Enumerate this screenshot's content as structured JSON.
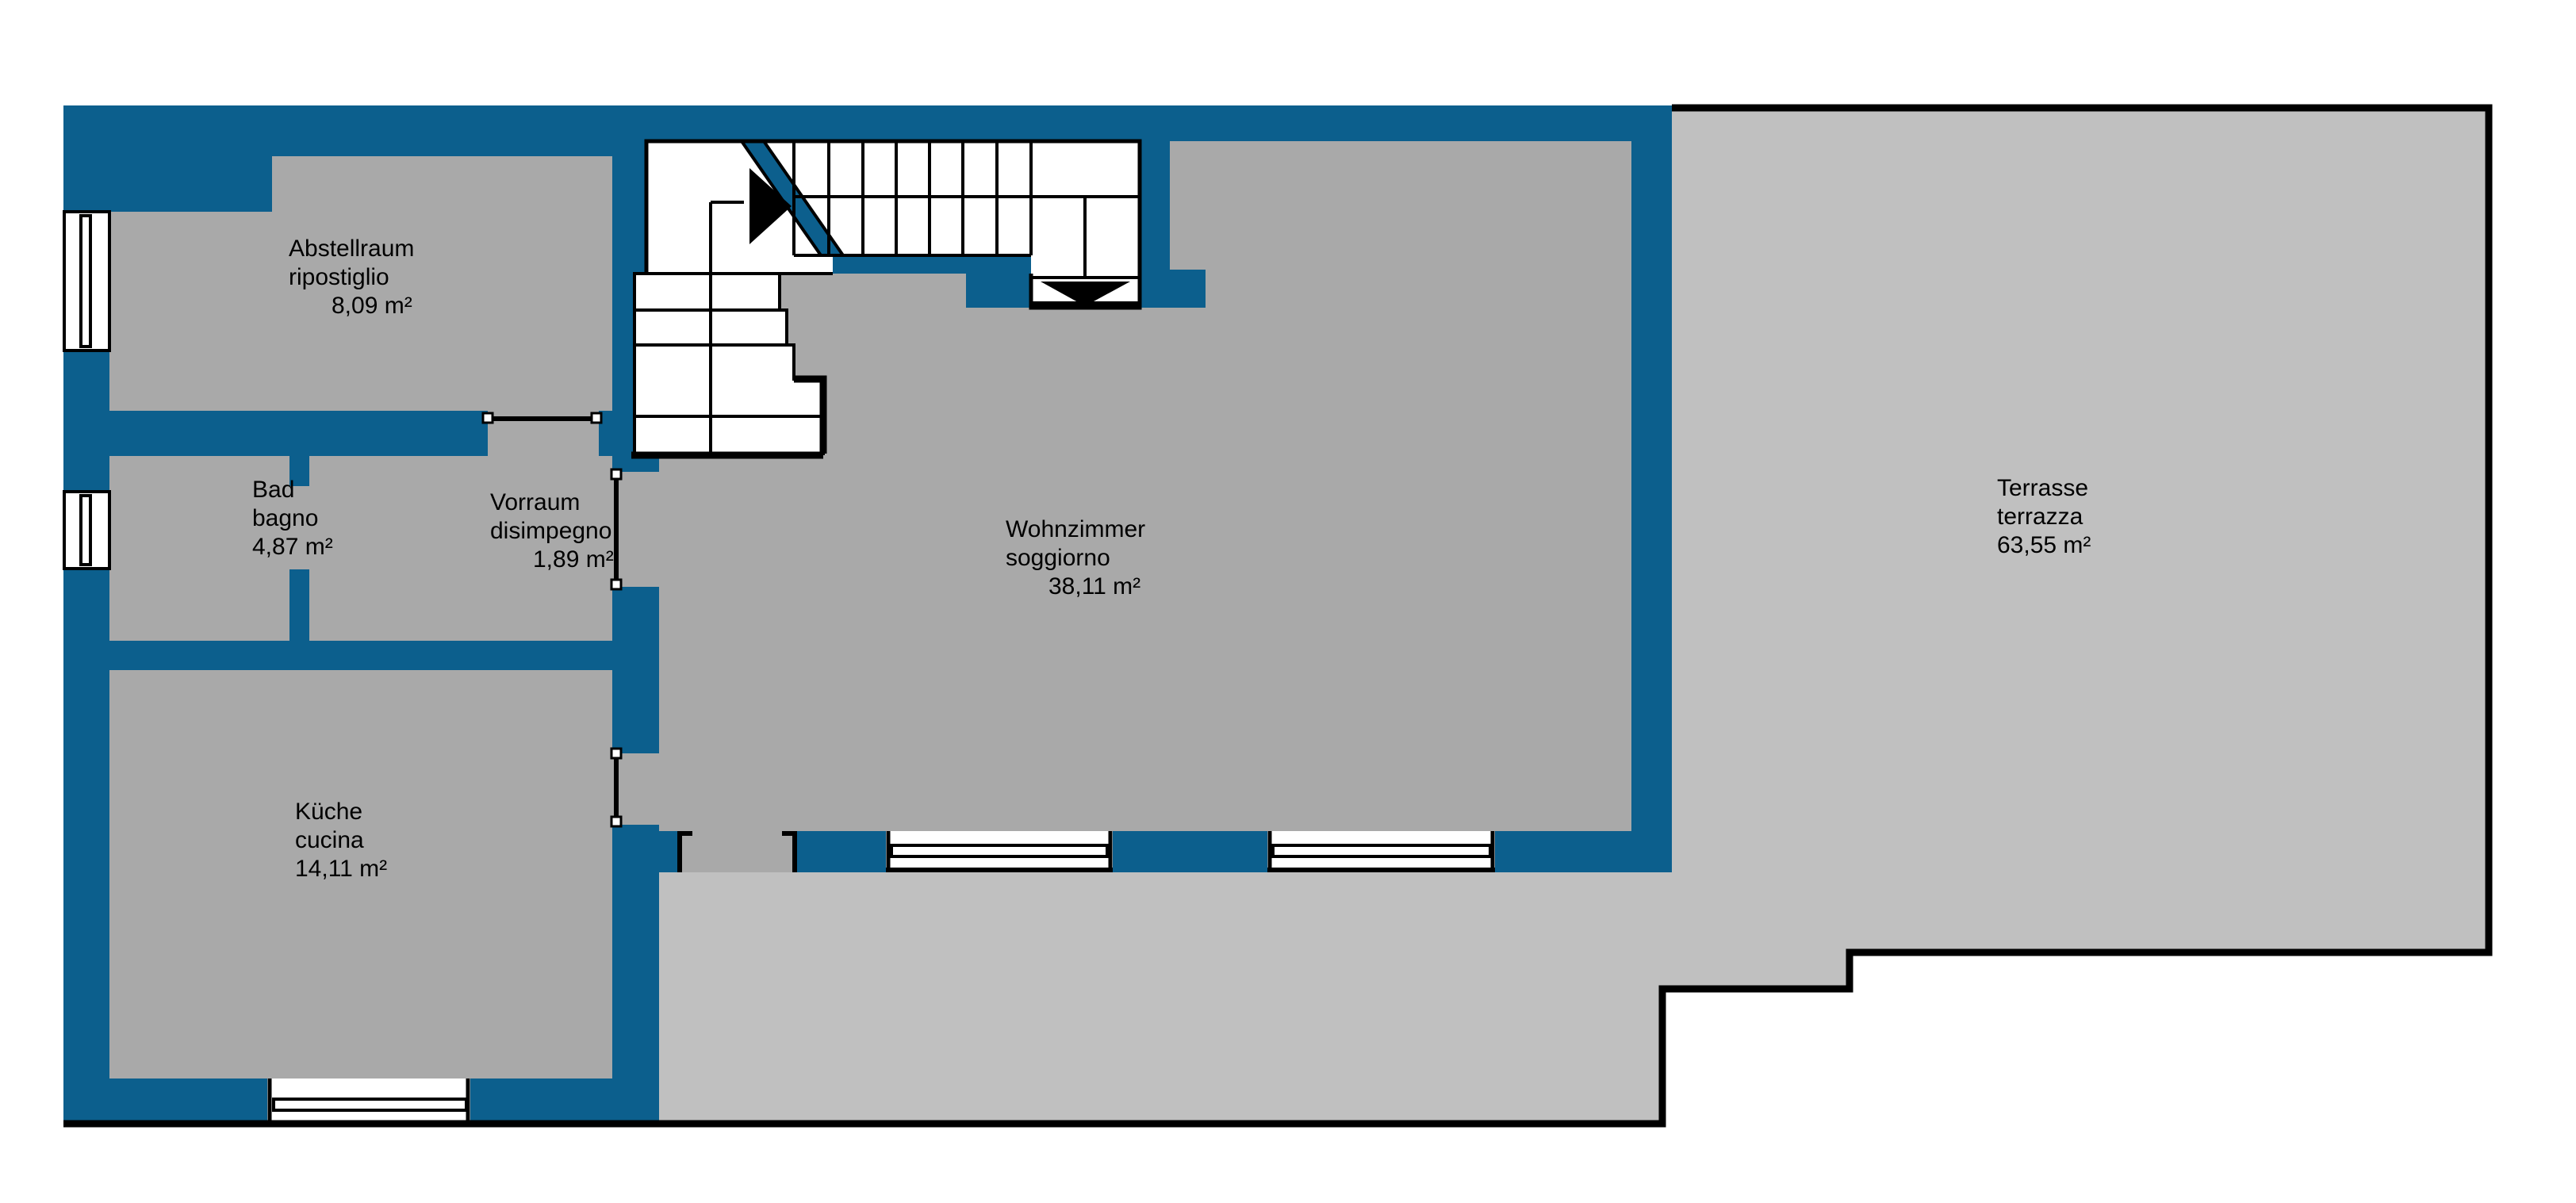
{
  "plan": {
    "type": "floor-plan",
    "languages": [
      "de",
      "it"
    ]
  },
  "colors": {
    "wall": "#0c5f8d",
    "room": "#a9a9a9",
    "terrace": "#c0c0c0",
    "outline": "#000000",
    "stairs": "#ffffff"
  },
  "rooms": [
    {
      "id": "abstellraum",
      "name_de": "Abstellraum",
      "name_it": "ripostiglio",
      "area": "8,09 m²"
    },
    {
      "id": "bad",
      "name_de": "Bad",
      "name_it": "bagno",
      "area": "4,87 m²"
    },
    {
      "id": "vorraum",
      "name_de": "Vorraum",
      "name_it": "disimpegno",
      "area": "1,89 m²"
    },
    {
      "id": "kueche",
      "name_de": "Küche",
      "name_it": "cucina",
      "area": "14,11 m²"
    },
    {
      "id": "wohnzimmer",
      "name_de": "Wohnzimmer",
      "name_it": "soggiorno",
      "area": "38,11 m²"
    },
    {
      "id": "terrasse",
      "name_de": "Terrasse",
      "name_it": "terrazza",
      "area": "63,55 m²"
    }
  ]
}
